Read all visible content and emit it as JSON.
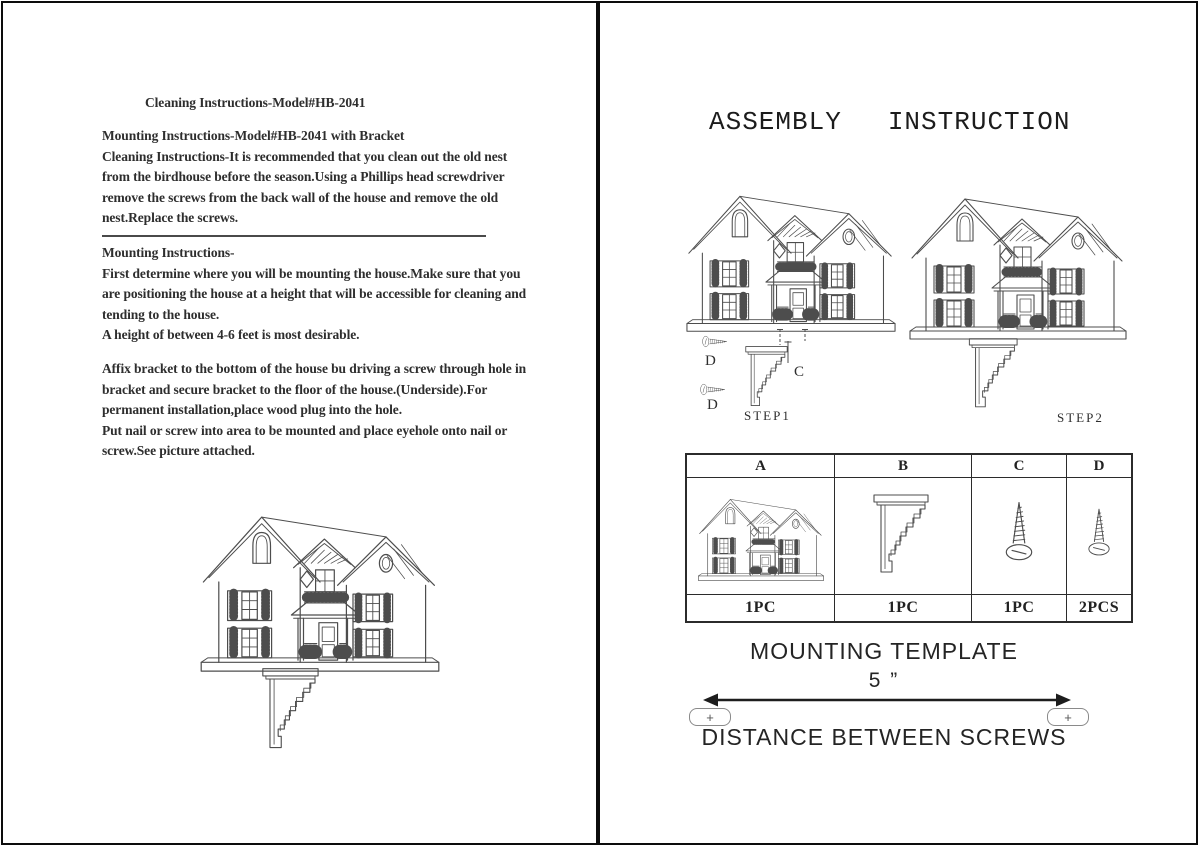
{
  "page_left": {
    "heading": "Cleaning Instructions-Model#HB-2041",
    "paragraph_cleaning": "Mounting Instructions-Model#HB-2041 with Bracket\nCleaning Instructions-It is recommended that you clean out the old nest\nfrom the birdhouse before the season.Using a Phillips head screwdriver\nremove the screws from the back wall of the house and remove the old\nnest.Replace the screws.",
    "paragraph_mounting": "Mounting Instructions-\nFirst determine where you will be mounting the house.Make sure that you\nare positioning the house at a height that will be accessible for cleaning and\ntending to the house.\nA height of between 4-6 feet is most desirable.",
    "paragraph_bracket": "Affix bracket to the bottom of the house bu driving a screw through hole in\nbracket and secure bracket to the floor of the house.(Underside).For\npermanent installation,place wood plug into the hole.\nPut nail or screw into area to be mounted and place eyehole onto nail or\nscrew.See picture attached."
  },
  "page_right": {
    "title": {
      "word1": "ASSEMBLY",
      "word2": "INSTRUCTION"
    },
    "steps": {
      "step1_caption": "STEP1",
      "step2_caption": "STEP2",
      "label_c": "C",
      "label_d_top": "D",
      "label_d_bottom": "D"
    },
    "parts_table": {
      "headers": [
        "A",
        "B",
        "C",
        "D"
      ],
      "quantities": [
        "1PC",
        "1PC",
        "1PC",
        "2PCS"
      ]
    },
    "template_section": {
      "title": "MOUNTING TEMPLATE",
      "distance_value": "5 ”",
      "plus_left": "+",
      "plus_right": "+",
      "distance_label": "DISTANCE BETWEEN SCREWS"
    }
  },
  "colors": {
    "ink": "#2e2e2e",
    "line_art": "#4d4d4d",
    "page_border": "#0c0c0c",
    "background": "#ffffff"
  }
}
